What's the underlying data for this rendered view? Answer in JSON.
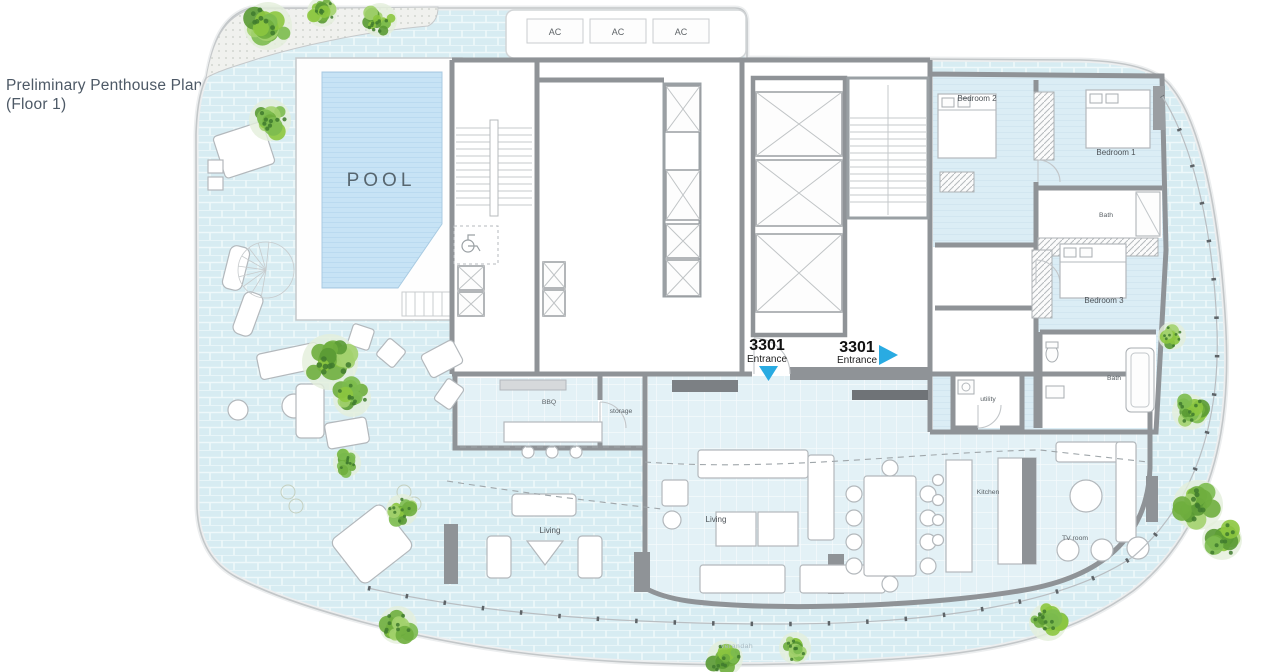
{
  "plan": {
    "title_line1": "Preliminary Penthouse Plan",
    "title_line2": "(Floor 1)"
  },
  "rooms": {
    "pool": "POOL",
    "bedroom1": "Bedroom 1",
    "bedroom2": "Bedroom 2",
    "bedroom3": "Bedroom 3",
    "bath_upper": "Bath",
    "bath_lower": "Bath",
    "bbq": "BBQ",
    "storage": "storage",
    "utility": "utility",
    "living_indoor": "Living",
    "living_outdoor": "Living",
    "kitchen": "Kitchen",
    "tv_room": "TV room",
    "verandah": "verandah"
  },
  "equipment": {
    "ac1": "AC",
    "ac2": "AC",
    "ac3": "AC"
  },
  "entrances": [
    {
      "number": "3301",
      "label": "Entrance",
      "direction": "down"
    },
    {
      "number": "3301",
      "label": "Entrance",
      "direction": "right"
    }
  ],
  "icons": {
    "tree": "tree-icon",
    "entrance_arrow_down": "entrance-arrow-down-icon",
    "entrance_arrow_right": "entrance-arrow-right-icon",
    "elevator_shaft": "elevator-shaft-icon",
    "stairs": "stairs-icon",
    "wheelchair": "wheelchair-icon"
  },
  "colors": {
    "terrace_tile": "#d7ecf2",
    "indoor_tile": "#e3f1f6",
    "pool_water": "#c7e3f5",
    "wall": "#8f9397",
    "dark_wall": "#6f7377",
    "tree_green": "#6fae3e",
    "entrance_arrow": "#29abe2",
    "title_text": "#4d5966"
  }
}
